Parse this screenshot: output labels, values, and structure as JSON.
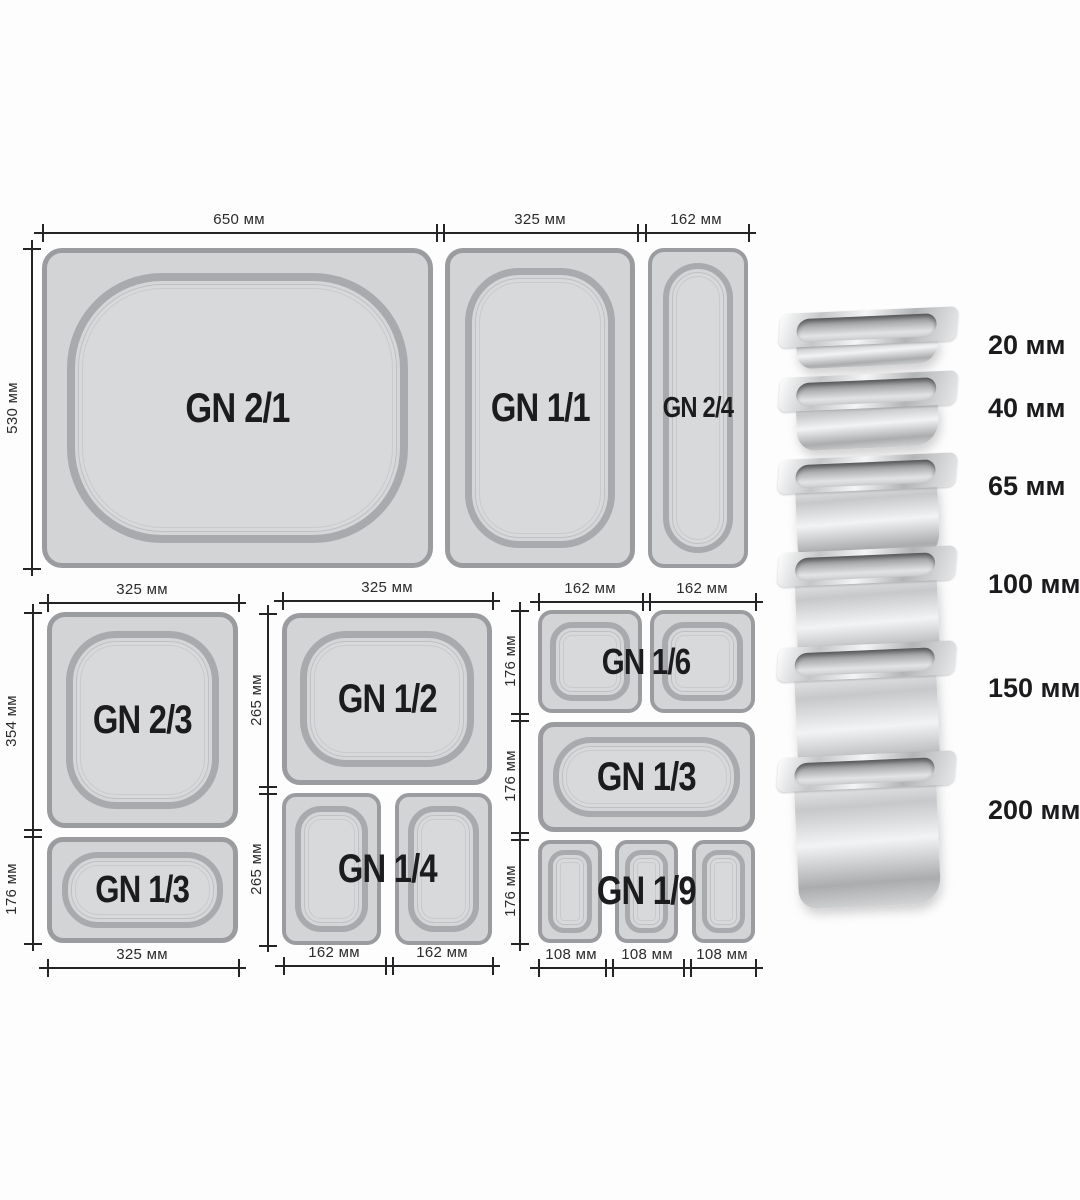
{
  "diagram": {
    "top_group": {
      "pans": [
        "GN 2/1",
        "GN 1/1",
        "GN 2/4"
      ],
      "width_labels": [
        "650 мм",
        "325 мм",
        "162 мм"
      ],
      "height_labels": [
        "530 мм"
      ]
    },
    "left_group": {
      "pans": [
        "GN 2/3",
        "GN 1/3"
      ],
      "top_width_labels": [
        "325 мм"
      ],
      "bottom_width_labels": [
        "325 мм"
      ],
      "height_labels": [
        "354 мм",
        "176 мм"
      ]
    },
    "middle_group": {
      "pans": [
        "GN 1/2",
        "GN 1/4"
      ],
      "top_width_labels": [
        "325 мм"
      ],
      "bottom_width_labels": [
        "162 мм",
        "162 мм"
      ],
      "height_labels": [
        "265 мм",
        "265 мм"
      ]
    },
    "right_group": {
      "pans": [
        "GN 1/6",
        "GN 1/3",
        "GN 1/9"
      ],
      "top_width_labels": [
        "162 мм",
        "162 мм"
      ],
      "bottom_width_labels": [
        "108 мм",
        "108 мм",
        "108 мм"
      ],
      "height_labels": [
        "176 мм",
        "176 мм",
        "176 мм"
      ]
    },
    "depths": [
      {
        "label": "20 мм"
      },
      {
        "label": "40 мм"
      },
      {
        "label": "65 мм"
      },
      {
        "label": "100 мм"
      },
      {
        "label": "150 мм"
      },
      {
        "label": "200 мм"
      }
    ],
    "colors": {
      "pan_fill": "#d3d4d6",
      "pan_border": "#9a9c9f",
      "rim": "#a8aaad",
      "text": "#1c1c1e",
      "dim_line": "#242426"
    }
  }
}
